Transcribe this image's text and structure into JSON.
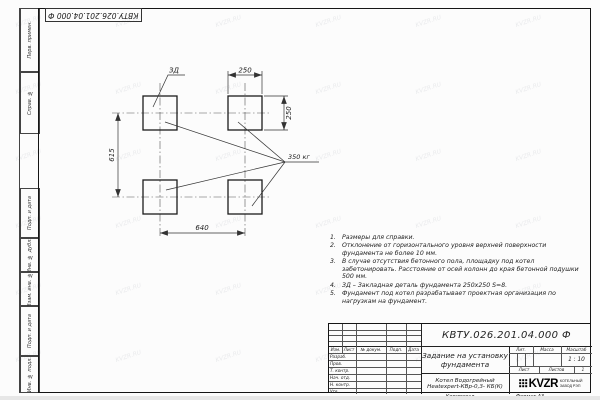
{
  "watermark": "KVZR.RU",
  "corner_doc_number": "КВТУ.026.201.04.000 Ф",
  "margin_labels": [
    "Перв. примен.",
    "Справ. №",
    "Подп. и дата",
    "Инв. № дубл.",
    "Взам. инв. №",
    "Подп. и дата",
    "Инв. № подл."
  ],
  "drawing": {
    "dim_top": "250",
    "dim_right": "250",
    "dim_left": "615",
    "dim_bottom": "640",
    "embed_label": "ЗД",
    "load_label": "350 кг"
  },
  "notes": [
    {
      "num": "1.",
      "text": "Размеры для справки."
    },
    {
      "num": "2.",
      "text": "Отклонение от горизонтального уровня верхней поверхности фундамента не более 10 мм."
    },
    {
      "num": "3.",
      "text": "В случае отсутствия бетонного пола, площадку под котел забетонировать. Расстояние от осей колонн до края бетонной подушки 500 мм."
    },
    {
      "num": "4.",
      "text": "ЗД – Закладная деталь фундамента 250х250 S=8."
    },
    {
      "num": "5.",
      "text": "Фундамент под котел разрабатывает проектная организация по нагрузкам на фундамент."
    }
  ],
  "title_block": {
    "doc_number": "КВТУ.026.201.04.000 Ф",
    "title": "Задание на установку фундамента",
    "product_line1": "Котел Водогрейный",
    "product_line2": "Heatexpert-КВр-0,3- КБ(К)",
    "header_cols": [
      "Изм.",
      "Лист",
      "№ докум.",
      "Подп.",
      "Дата"
    ],
    "signature_rows": [
      "Разраб.",
      "Пров.",
      "Т. контр.",
      "Нач. отд.",
      "Н. контр.",
      "Утв."
    ],
    "lit_label": "Лит.",
    "mass_label": "Масса",
    "scale_label": "Масштаб",
    "scale_value": "1 : 10",
    "sheet_label": "Лист",
    "sheets_label": "Листов",
    "sheets_value": "1",
    "logo_text": "KVZR",
    "logo_caption_line1": "КОТЕЛЬНЫЙ",
    "logo_caption_line2": "ЗАВОД РЭП",
    "copied_label": "Копировал",
    "format_label": "Формат А3"
  }
}
